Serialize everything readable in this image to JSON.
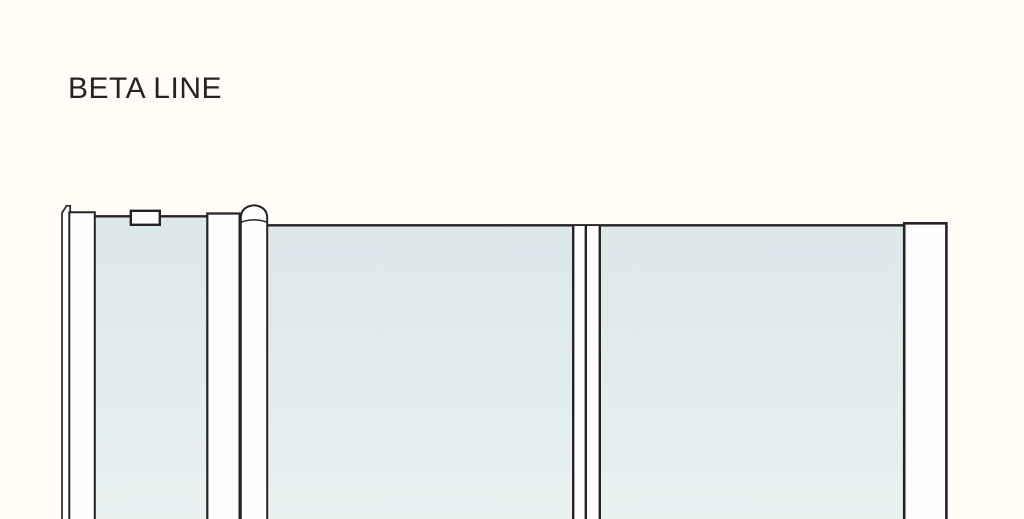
{
  "title": "BETA LINE",
  "colors": {
    "background": "#FFFDF6",
    "line": "#272223",
    "fill_white": "#FEFEFE",
    "glass_top": "#DBE7EA",
    "glass_bottom": "#E9F1F1"
  }
}
